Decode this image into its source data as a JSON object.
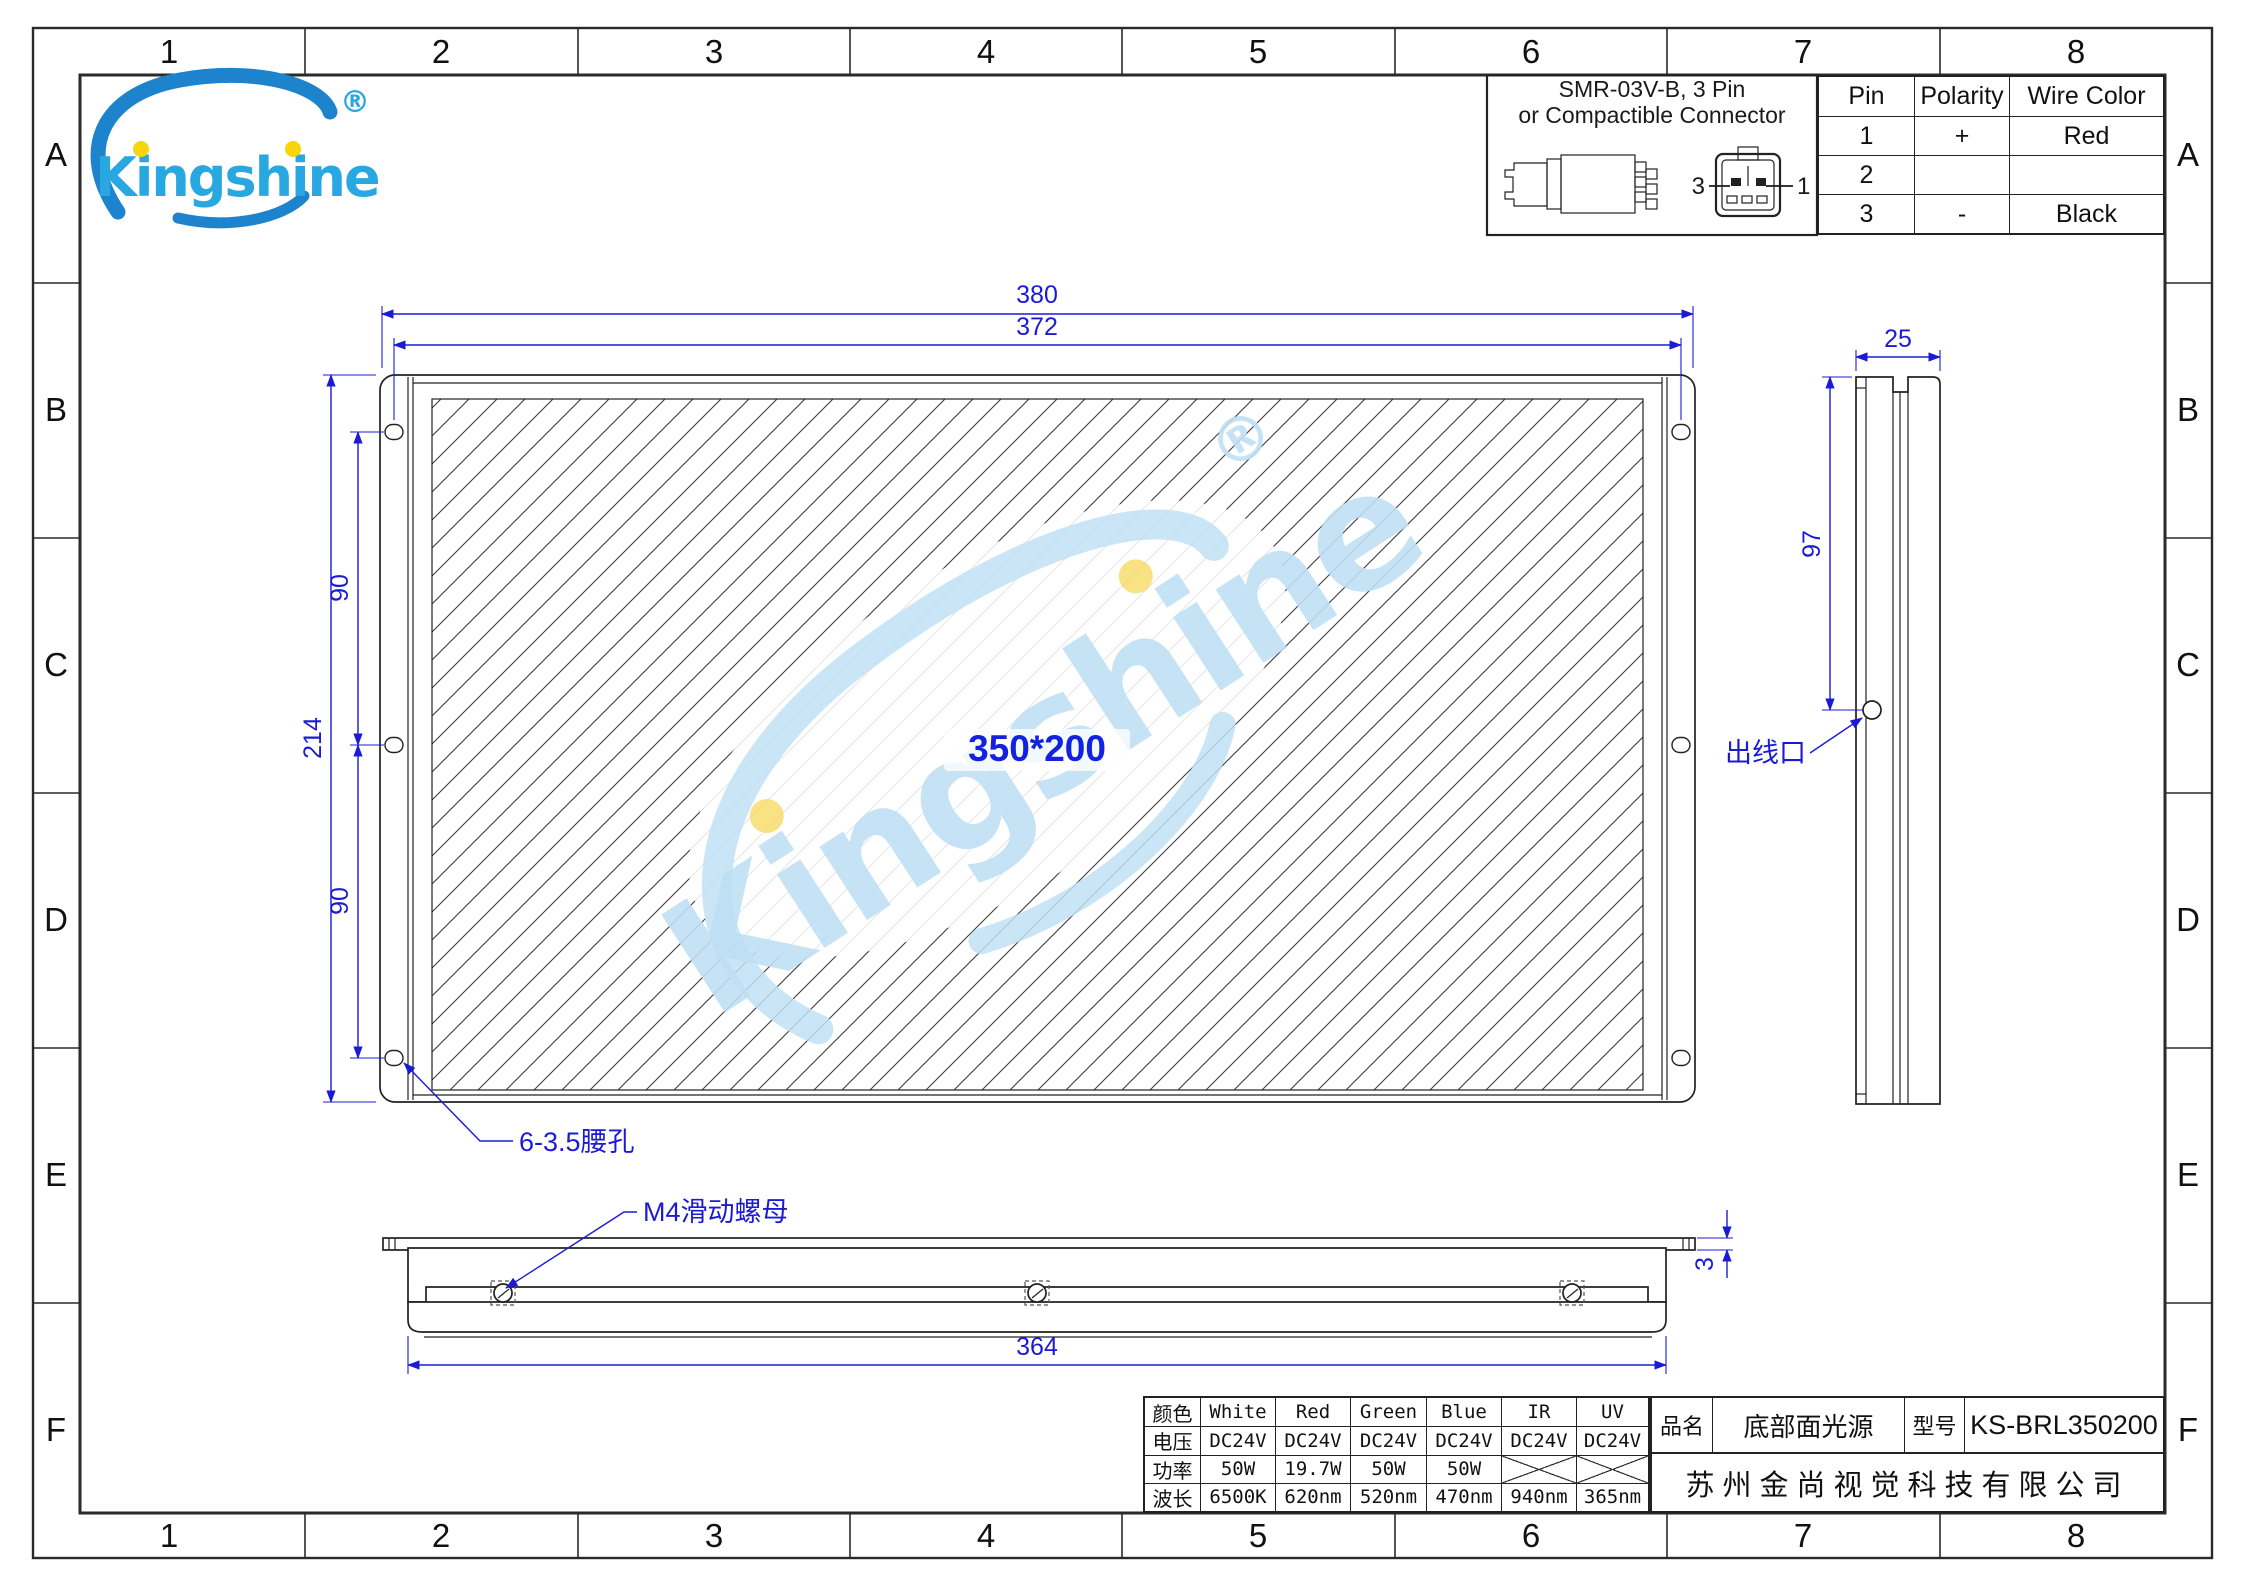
{
  "grid": {
    "cols": [
      "1",
      "2",
      "3",
      "4",
      "5",
      "6",
      "7",
      "8"
    ],
    "rows": [
      "A",
      "B",
      "C",
      "D",
      "E",
      "F"
    ]
  },
  "logo": {
    "text": "Kingshine",
    "registered": "®"
  },
  "connector": {
    "title_line1": "SMR-03V-B, 3 Pin",
    "title_line2": "or Compactible Connector",
    "lead_left": "3",
    "lead_right": "1",
    "pin_table": {
      "headers": [
        "Pin",
        "Polarity",
        "Wire Color"
      ],
      "rows": [
        [
          "1",
          "+",
          "Red"
        ],
        [
          "2",
          "",
          ""
        ],
        [
          "3",
          "-",
          "Black"
        ]
      ]
    }
  },
  "front_view": {
    "dim_width_outer": "380",
    "dim_width_holes": "372",
    "dim_height": "214",
    "dim_hole_span_top": "90",
    "dim_hole_span_bottom": "90",
    "window_label": "350*200",
    "slot_callout": "6-3.5腰孔"
  },
  "bottom_view": {
    "dim_length": "364",
    "dim_plate_thickness": "3",
    "nut_callout": "M4滑动螺母"
  },
  "side_view": {
    "dim_depth": "25",
    "dim_exit_height": "97",
    "exit_callout": "出线口"
  },
  "spec_table": {
    "rows": [
      {
        "label": "颜色",
        "values": [
          "White",
          "Red",
          "Green",
          "Blue",
          "IR",
          "UV"
        ]
      },
      {
        "label": "电压",
        "values": [
          "DC24V",
          "DC24V",
          "DC24V",
          "DC24V",
          "DC24V",
          "DC24V"
        ]
      },
      {
        "label": "功率",
        "values": [
          "50W",
          "19.7W",
          "50W",
          "50W",
          "",
          ""
        ]
      },
      {
        "label": "波长",
        "values": [
          "6500K",
          "620nm",
          "520nm",
          "470nm",
          "940nm",
          "365nm"
        ]
      }
    ]
  },
  "title_block": {
    "name_label": "品名",
    "name": "底部面光源",
    "model_label": "型号",
    "model": "KS-BRL350200",
    "company": "苏州金尚视觉科技有限公司"
  },
  "colors": {
    "dimension_blue": "#1b1bd6",
    "line_dark": "#222222",
    "logo_blue": "#29a7e0",
    "logo_swoosh": "#1d83cc",
    "logo_yellow": "#f9d40a",
    "watermark_blue": "#bfe0f4"
  }
}
